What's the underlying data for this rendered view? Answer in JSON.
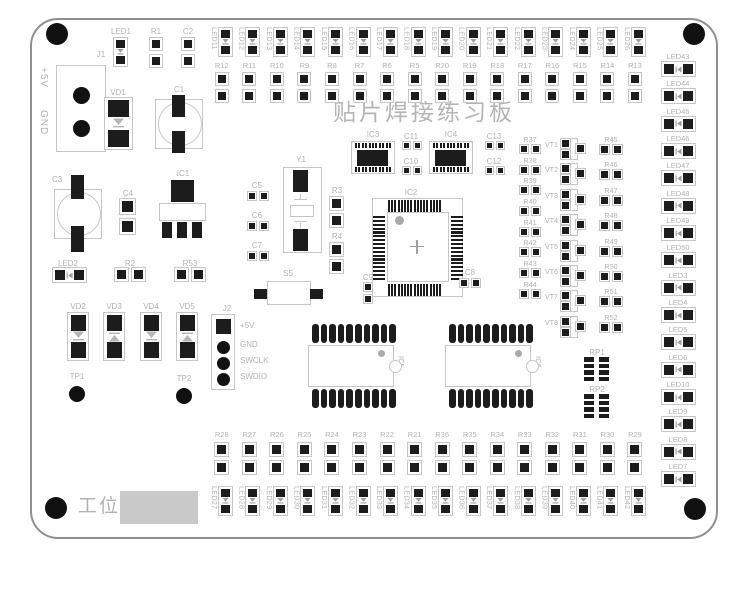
{
  "title": "贴片焊接练习板",
  "station": {
    "label": "工位:"
  },
  "colors": {
    "pad": "#1c1c1c",
    "silkscreen": "#b2b2b2",
    "station_box": "#c9c9c9"
  },
  "connectors": {
    "j1": {
      "label": "J1",
      "pin_labels": [
        "+5V",
        "GND"
      ]
    },
    "j2": {
      "label": "J2",
      "pin_labels": [
        "+5V",
        "GND",
        "SWCLK",
        "SWDIO"
      ]
    }
  },
  "parts": {
    "j1": "J1",
    "vd1": "VD1",
    "c1": "C1",
    "led1": "LED1",
    "r1": "R1",
    "c2": "C2",
    "c3": "C3",
    "c4": "C4",
    "ic1": "IC1",
    "led2": "LED2",
    "r2": "R2",
    "r53": "R53",
    "vd2": "VD2",
    "vd3": "VD3",
    "vd4": "VD4",
    "vd5": "VD5",
    "tp1": "TP1",
    "tp2": "TP2",
    "j2": "J2",
    "y1": "Y1",
    "c5": "C5",
    "c6": "C6",
    "c7": "C7",
    "r3": "R3",
    "r4": "R4",
    "s5": "S5",
    "ic2": "IC2",
    "c8": "C8",
    "c9": "C9",
    "ic3": "IC3",
    "ic4": "IC4",
    "c10": "C10",
    "c11": "C11",
    "c12": "C12",
    "c13": "C13",
    "ic5": "IC5",
    "ic6": "IC6",
    "rp1": "RP1",
    "rp2": "RP2"
  },
  "strips": {
    "top_leds": [
      "LED11",
      "LED12",
      "LED13",
      "LED14",
      "LED15",
      "LED16",
      "LED17",
      "LED18",
      "LED19",
      "LED20",
      "LED21",
      "LED22",
      "LED23",
      "LED24",
      "LED25",
      "LED26"
    ],
    "top_resistors": [
      "R12",
      "R11",
      "R10",
      "R9",
      "R8",
      "R7",
      "R6",
      "R5",
      "R20",
      "R19",
      "R18",
      "R17",
      "R16",
      "R15",
      "R14",
      "R13"
    ],
    "bottom_resistors": [
      "R28",
      "R27",
      "R26",
      "R25",
      "R24",
      "R23",
      "R22",
      "R21",
      "R36",
      "R35",
      "R34",
      "R33",
      "R32",
      "R31",
      "R30",
      "R29"
    ],
    "bottom_leds": [
      "LED27",
      "LED28",
      "LED29",
      "LED30",
      "LED31",
      "LED32",
      "LED33",
      "LED34",
      "LED35",
      "LED36",
      "LED37",
      "LED38",
      "LED39",
      "LED40",
      "LED41",
      "LED42"
    ],
    "right_leds": [
      "LED43",
      "LED44",
      "LED45",
      "LED46",
      "LED47",
      "LED48",
      "LED49",
      "LED50",
      "LED3",
      "LED4",
      "LED5",
      "LED6",
      "LED10",
      "LED9",
      "LED8",
      "LED7"
    ]
  },
  "blocks": {
    "resistors_left": [
      "R37",
      "R38",
      "R39",
      "R40",
      "R41",
      "R42",
      "R43",
      "R44"
    ],
    "transistors": [
      "VT1",
      "VT2",
      "VT3",
      "VT4",
      "VT5",
      "VT6",
      "VT7",
      "VT8"
    ],
    "resistors_right": [
      "R45",
      "R46",
      "R47",
      "R48",
      "R49",
      "R50",
      "R51",
      "R52"
    ]
  }
}
